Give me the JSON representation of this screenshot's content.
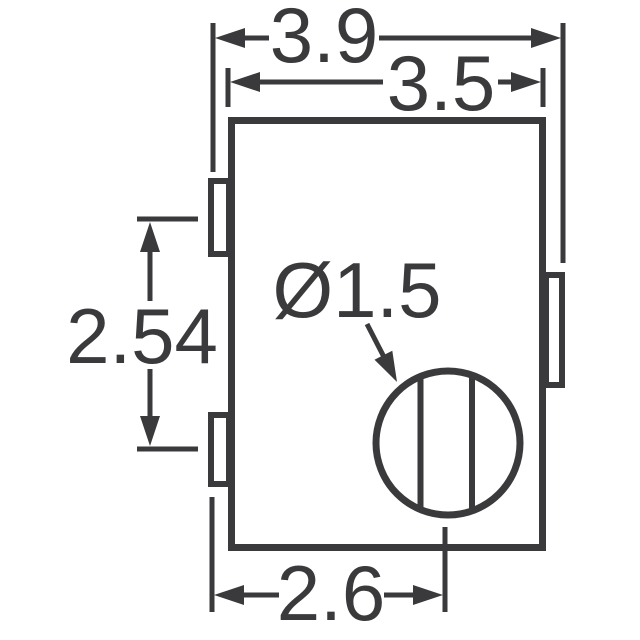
{
  "drawing": {
    "kind": "mechanical-dimension-drawing",
    "colors": {
      "stroke": "#3a3a3c",
      "background": "#ffffff"
    },
    "labels": {
      "overall_width": "3.9",
      "body_width": "3.5",
      "terminal_pitch": "2.54",
      "pad_to_rotor": "2.6",
      "rotor_diameter": "Ø1.5"
    }
  }
}
